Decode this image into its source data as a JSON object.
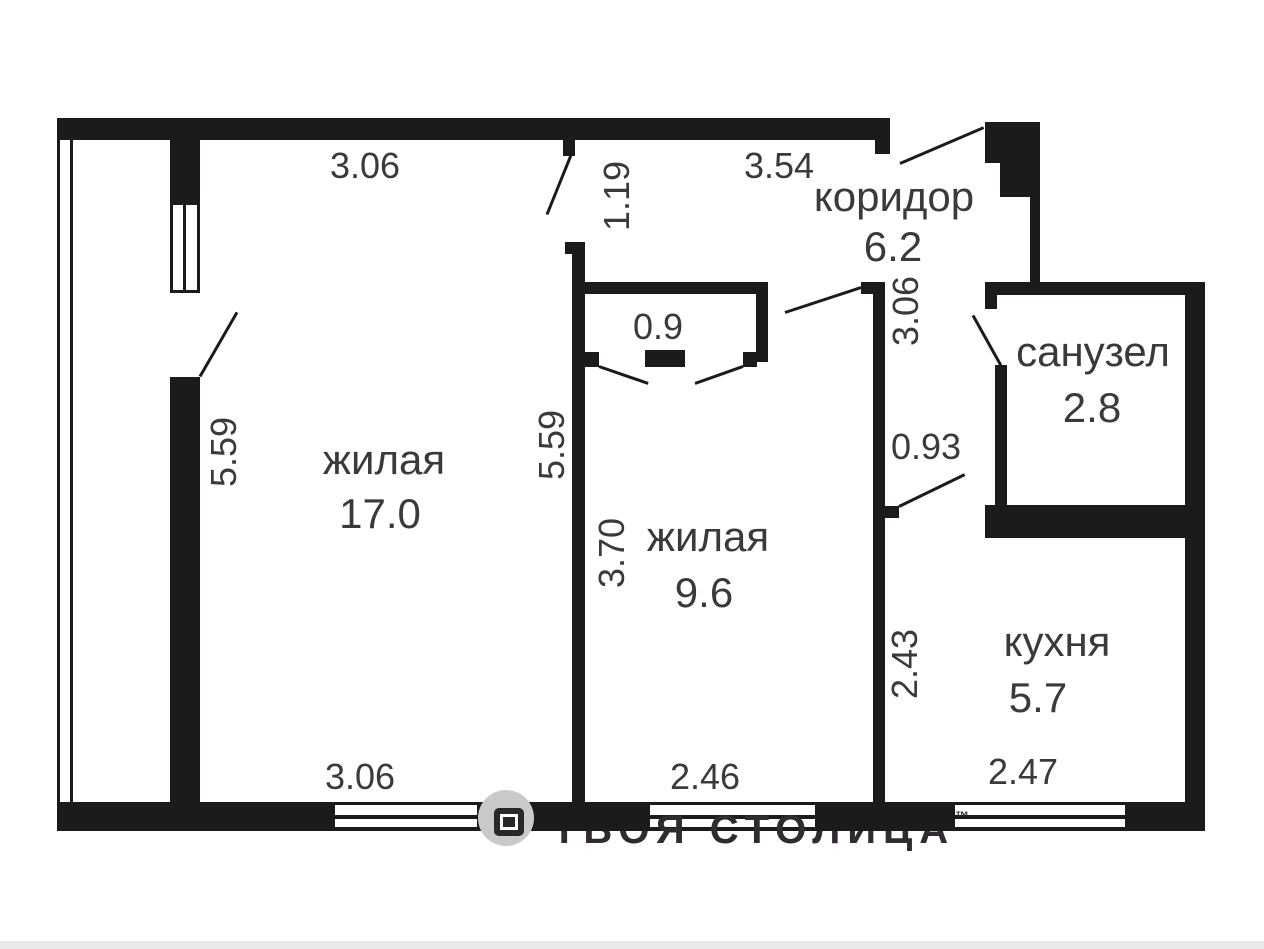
{
  "plan_type": "apartment-floor-plan",
  "rooms": [
    {
      "name": "жилая",
      "area": "17.0"
    },
    {
      "name": "жилая",
      "area": "9.6"
    },
    {
      "name": "коридор",
      "area": "6.2"
    },
    {
      "name": "санузел",
      "area": "2.8"
    },
    {
      "name": "кухня",
      "area": "5.7"
    },
    {
      "name": "closet",
      "area": "0.9"
    }
  ],
  "dims": {
    "w1_top": "3.06",
    "w2_top": "3.54",
    "entry": "1.19",
    "h_left": "5.59",
    "h_mid": "5.59",
    "h_room2": "3.70",
    "h_corridor": "3.06",
    "kitchen_door": "0.93",
    "h_kitchen": "2.43",
    "b_room1": "3.06",
    "b_room2": "2.46",
    "b_kitchen": "2.47"
  },
  "watermark": {
    "brand": "ТВОЯ СТОЛИЦА",
    "tm": "™"
  },
  "colors": {
    "wall": "#1d1a1e",
    "label": "#3a3a3a",
    "watermark_gray": "#c9c9c9",
    "footer": "#ebe9ec"
  }
}
